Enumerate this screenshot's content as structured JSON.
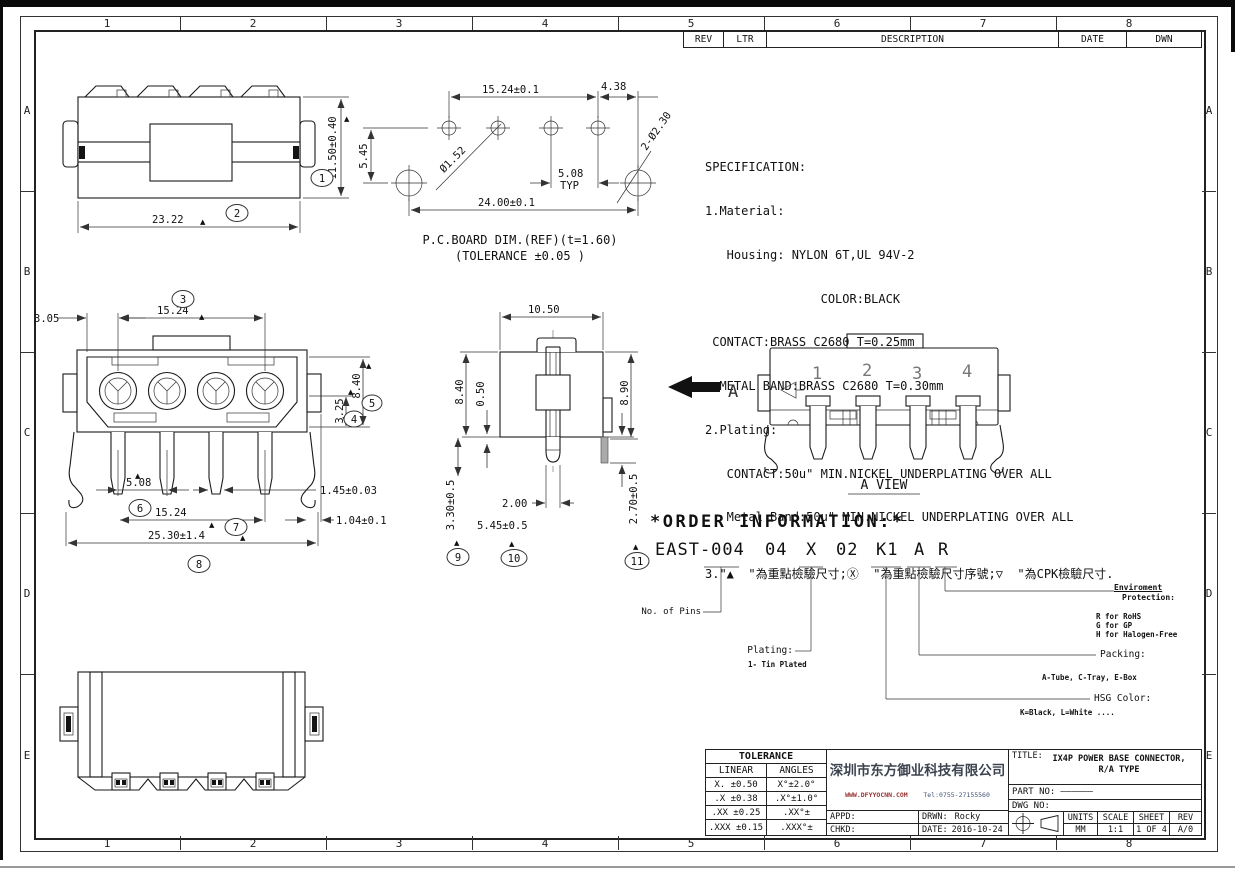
{
  "sym": {
    "tri": "▲"
  },
  "frame": {
    "cols": [
      "1",
      "2",
      "3",
      "4",
      "5",
      "6",
      "7",
      "8"
    ],
    "rows": [
      "A",
      "B",
      "C",
      "D",
      "E"
    ]
  },
  "rev_table": {
    "rev": "REV",
    "ltr": "LTR",
    "description": "DESCRIPTION",
    "date": "DATE",
    "dwn": "DWN"
  },
  "spec": {
    "lines": [
      "SPECIFICATION:",
      "1.Material:",
      "   Housing: NYLON 6T,UL 94V-2",
      "                COLOR:BLACK",
      " CONTACT:BRASS C2680 T=0.25mm",
      "  METAL BAND:BRASS C2680 T=0.30mm",
      "2.Plating:",
      "   CONTACT:50u\" MIN.NICKEL UNDERPLATING OVER ALL",
      "   Metal Band:50u\" MIN.NICKEL UNDERPLATING OVER ALL",
      "3.\"▲  \"為重點檢驗尺寸;Ⓧ  \"為重點檢驗尺寸序號;▽  \"為CPK檢驗尺寸."
    ]
  },
  "views": {
    "top_view": {
      "d_h": "11.50±0.40",
      "d_w": "23.22",
      "b1": "1",
      "b2": "2"
    },
    "pcb": {
      "d_pitch": "15.24±0.1",
      "d_438": "4.38",
      "d_hole": "Ø1.52",
      "d_508": "5.08",
      "typ": "TYP",
      "d_hole2": "2-Ø2.30",
      "d_width": "24.00±0.1",
      "d_545": "5.45",
      "cap1": "P.C.BOARD DIM.(REF)(t=1.60)",
      "cap2": "(TOLERANCE ±0.05 )"
    },
    "front": {
      "d_305": "3.05",
      "d_1524a": "15.24",
      "d_325": "3.25",
      "d_840": "8.40",
      "d_508": "5.08",
      "d_145": "1.45±0.03",
      "d_1524b": "15.24",
      "d_104": "1.04±0.1",
      "d_2530": "25.30±1.4",
      "b3": "3",
      "b4": "4",
      "b5": "5",
      "b6": "6",
      "b7": "7",
      "b8": "8"
    },
    "side": {
      "d_1050": "10.50",
      "d_840": "8.40",
      "d_050": "0.50",
      "d_890": "8.90",
      "d_330": "3.30±0.5",
      "d_200": "2.00",
      "d_545": "5.45±0.5",
      "d_270": "2.70±0.5",
      "b9": "9",
      "b10": "10",
      "b11": "11"
    },
    "a_view": {
      "label": "A",
      "p1": "1",
      "p2": "2",
      "p3": "3",
      "p4": "4",
      "caption": "A VIEW"
    }
  },
  "order": {
    "title": "*ORDER INFORMATION:*",
    "segments": [
      "EAST-004",
      "04",
      "X",
      "02",
      "K1",
      "A",
      "R"
    ],
    "no_of_pins": "No. of Pins",
    "plating": "Plating:",
    "plating_sub": "1- Tin Plated",
    "env1": "Enviroment",
    "env2": "Protection:",
    "env_r": "R for RoHS",
    "env_g": "G for GP",
    "env_h": "H for Halogen-Free",
    "packing": "Packing:",
    "packing_sub": "A-Tube, C-Tray, E-Box",
    "hsg": "HSG Color:",
    "hsg_sub": "K=Black, L=White ...."
  },
  "title_block": {
    "tol_title": "TOLERANCE",
    "tol_h1": "LINEAR",
    "tol_h2": "ANGLES",
    "tol_rows": [
      [
        "X. ±0.50",
        "X°±2.0°"
      ],
      [
        ".X ±0.38",
        ".X°±1.0°"
      ],
      [
        ".XX ±0.25",
        ".XX°±"
      ],
      [
        ".XXX ±0.15",
        ".XXX°±"
      ]
    ],
    "company_name": "深圳市东方御业科技有限公司",
    "company_web": "WWW.DFYYOCNN.COM",
    "company_tel": "Tel:0755-27155560",
    "title_label": "TITLE:",
    "title_line1": "IX4P POWER BASE CONNECTOR,",
    "title_line2": "R/A TYPE",
    "part_label": "PART NO:",
    "part_value": "——————",
    "dwg_label": "DWG NO:",
    "appd": "APPD:",
    "chkd": "CHKD:",
    "drwn_label": "DRWN:",
    "drwn_value": "Rocky",
    "date_label": "DATE:",
    "date_value": "2016-10-24",
    "units_label": "UNITS",
    "units_value": "MM",
    "scale_label": "SCALE",
    "scale_value": "1:1",
    "sheet_label": "SHEET",
    "sheet_value": "1 OF 4",
    "rev_label": "REV",
    "rev_value": "A/0"
  }
}
